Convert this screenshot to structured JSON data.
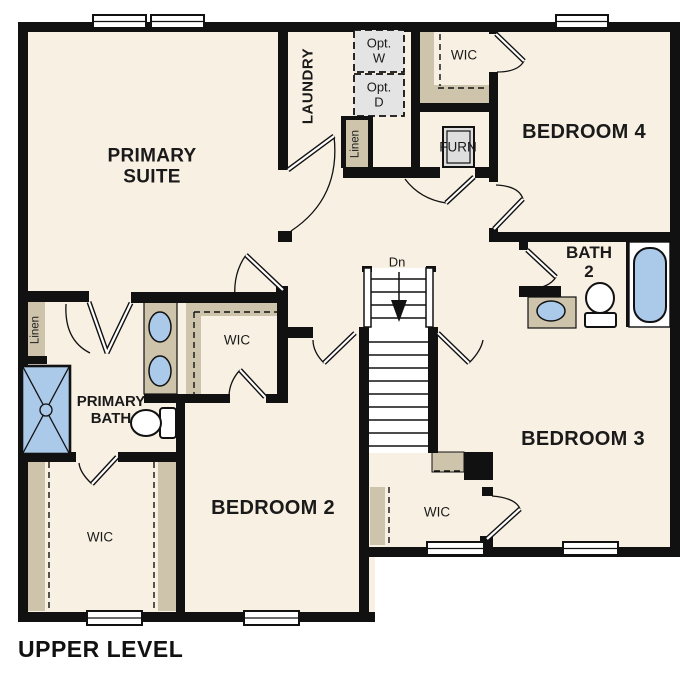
{
  "caption": "UPPER LEVEL",
  "colors": {
    "floor": "#f8f0e3",
    "wall": "#111111",
    "shelf_tan": "#cec4ac",
    "fixture_blue": "#abc9e9",
    "appliance_gray": "#e4e4e4"
  },
  "rooms": {
    "primary_suite": {
      "line1": "PRIMARY",
      "line2": "SUITE"
    },
    "laundry": {
      "label": "LAUNDRY"
    },
    "bedroom_2": {
      "label": "BEDROOM 2"
    },
    "bedroom_3": {
      "label": "BEDROOM 3"
    },
    "bedroom_4": {
      "label": "BEDROOM 4"
    },
    "primary_bath": {
      "line1": "PRIMARY",
      "line2": "BATH"
    },
    "bath_2": {
      "line1": "BATH",
      "line2": "2"
    },
    "wic_top": {
      "label": "WIC"
    },
    "wic_middle": {
      "label": "WIC"
    },
    "wic_bottom_left": {
      "label": "WIC"
    },
    "wic_bottom_right": {
      "label": "WIC"
    }
  },
  "features": {
    "optional_washer": {
      "line1": "Opt.",
      "line2": "W"
    },
    "optional_dryer": {
      "line1": "Opt.",
      "line2": "D"
    },
    "furnace": {
      "label": "FURN"
    },
    "linen_hall": {
      "label": "Linen"
    },
    "linen_laundry": {
      "label": "Linen"
    },
    "stairs_down": {
      "label": "Dn"
    }
  }
}
